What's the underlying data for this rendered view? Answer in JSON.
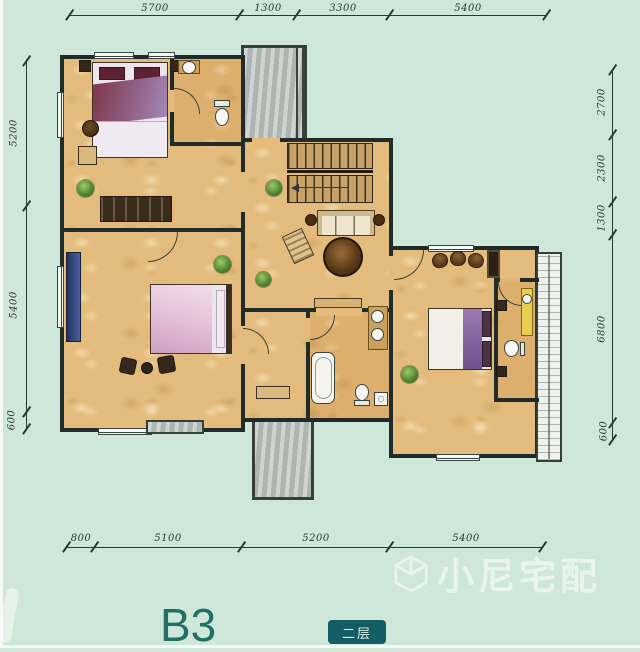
{
  "colors": {
    "background": "#cfe7d8",
    "wall": "#202c29",
    "ink": "#2c3833",
    "floor": "#e3bc7d",
    "gray": "#bac2bc",
    "accent": "#217068",
    "badge_bg": "#155d64",
    "badge_text": "#d6efe3",
    "watermark": "rgba(255,255,255,0.55)"
  },
  "plan": {
    "title": "B3",
    "floor_badge": "二层",
    "watermark": "小尼宅配"
  },
  "dims": {
    "top": [
      "5700",
      "1300",
      "3300",
      "5400"
    ],
    "bottom": [
      "800",
      "5100",
      "5200",
      "5400"
    ],
    "left": [
      "5200",
      "5400",
      "600"
    ],
    "right": [
      "2700",
      "2300",
      "1300",
      "6800",
      "600"
    ]
  }
}
